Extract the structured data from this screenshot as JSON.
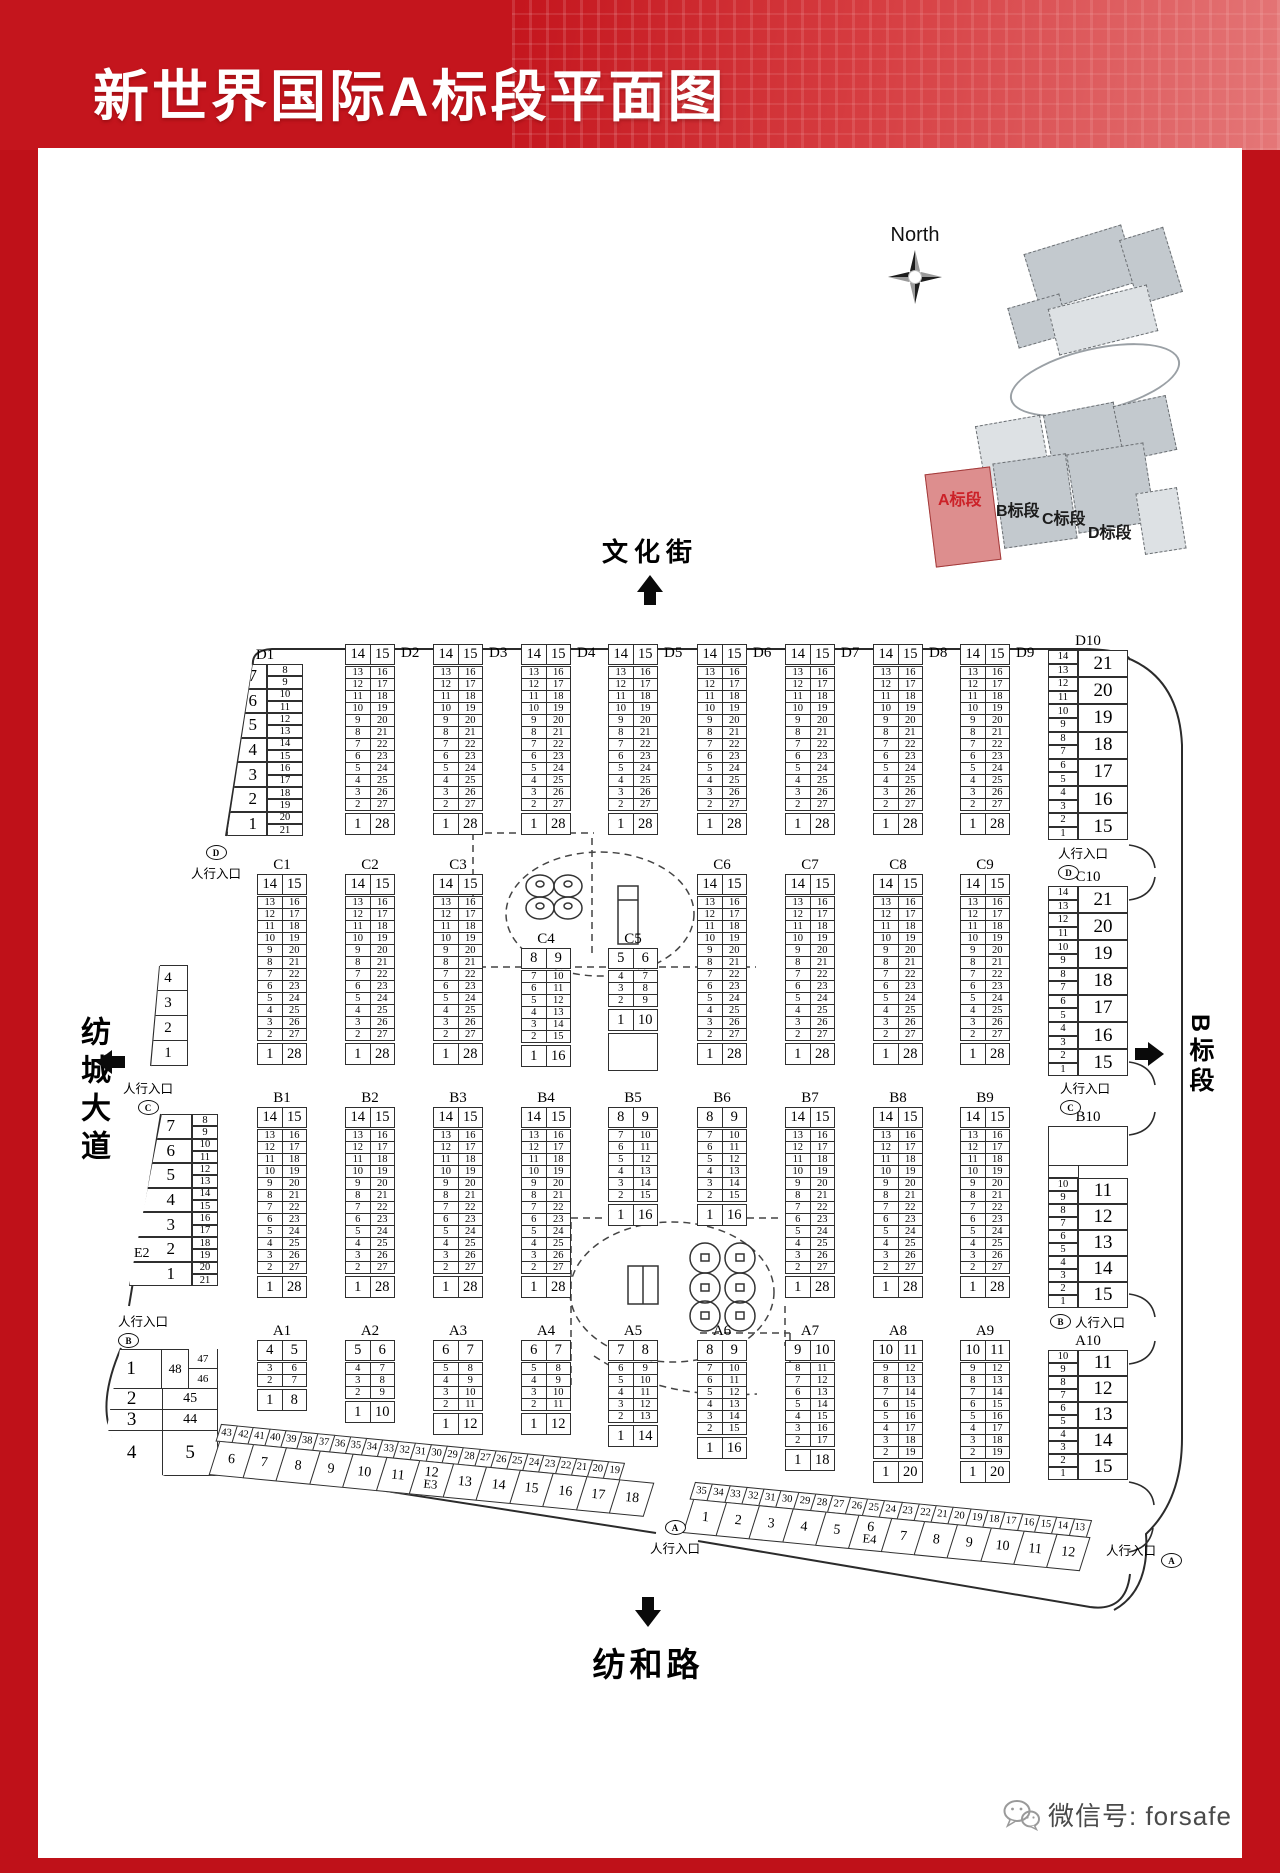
{
  "title": "新世界国际A标段平面图",
  "compass": {
    "label": "North"
  },
  "minimap": {
    "sections": [
      {
        "label": "A标段",
        "highlight": true
      },
      {
        "label": "B标段",
        "highlight": false
      },
      {
        "label": "C标段",
        "highlight": false
      },
      {
        "label": "D标段",
        "highlight": false
      }
    ]
  },
  "streets": {
    "top": "文化街",
    "left": "纺城大道",
    "right": "B标段",
    "bottom": "纺和路"
  },
  "entrance_text": "人行入口",
  "entrances": [
    {
      "letter": "D"
    },
    {
      "letter": "D"
    },
    {
      "letter": "C"
    },
    {
      "letter": "C"
    },
    {
      "letter": "B"
    },
    {
      "letter": "B"
    },
    {
      "letter": "A"
    },
    {
      "letter": "A"
    }
  ],
  "footer": {
    "wechat": "微信号: forsafe"
  },
  "colors": {
    "frame_red": "#bf1119",
    "banner_red": "#c4151d",
    "accent_red": "#cc2128",
    "line": "#2f2f2f"
  },
  "block_types": {
    "std28": {
      "kind": "std",
      "head": [
        "14",
        "15"
      ],
      "mid": [
        [
          "13",
          "16"
        ],
        [
          "12",
          "17"
        ],
        [
          "11",
          "18"
        ],
        [
          "10",
          "19"
        ],
        [
          "9",
          "20"
        ],
        [
          "8",
          "21"
        ],
        [
          "7",
          "22"
        ],
        [
          "6",
          "23"
        ],
        [
          "5",
          "24"
        ],
        [
          "4",
          "25"
        ],
        [
          "3",
          "26"
        ],
        [
          "2",
          "27"
        ]
      ],
      "foot": [
        "1",
        "28"
      ]
    },
    "short16": {
      "kind": "std",
      "head": [
        "8",
        "9"
      ],
      "mid": [
        [
          "7",
          "10"
        ],
        [
          "6",
          "11"
        ],
        [
          "5",
          "12"
        ],
        [
          "4",
          "13"
        ],
        [
          "3",
          "14"
        ],
        [
          "2",
          "15"
        ]
      ],
      "foot": [
        "1",
        "16"
      ]
    },
    "c5t": {
      "kind": "std",
      "head": [
        "5",
        "6"
      ],
      "mid": [
        [
          "4",
          "7"
        ],
        [
          "3",
          "8"
        ],
        [
          "2",
          "9"
        ]
      ],
      "foot": [
        "1",
        "10"
      ],
      "empty": 36
    },
    "a1t": {
      "kind": "std",
      "head": [
        "4",
        "5"
      ],
      "mid": [
        [
          "3",
          "6"
        ],
        [
          "2",
          "7"
        ]
      ],
      "foot": [
        "1",
        "8"
      ]
    },
    "a2t": {
      "kind": "std",
      "head": [
        "5",
        "6"
      ],
      "mid": [
        [
          "4",
          "7"
        ],
        [
          "3",
          "8"
        ],
        [
          "2",
          "9"
        ]
      ],
      "foot": [
        "1",
        "10"
      ]
    },
    "a3t": {
      "kind": "std",
      "head": [
        "6",
        "7"
      ],
      "mid": [
        [
          "5",
          "8"
        ],
        [
          "4",
          "9"
        ],
        [
          "3",
          "10"
        ],
        [
          "2",
          "11"
        ]
      ],
      "foot": [
        "1",
        "12"
      ]
    },
    "a5t": {
      "kind": "std",
      "head": [
        "7",
        "8"
      ],
      "mid": [
        [
          "6",
          "9"
        ],
        [
          "5",
          "10"
        ],
        [
          "4",
          "11"
        ],
        [
          "3",
          "12"
        ],
        [
          "2",
          "13"
        ]
      ],
      "foot": [
        "1",
        "14"
      ]
    },
    "a7t": {
      "kind": "std",
      "head": [
        "9",
        "10"
      ],
      "mid": [
        [
          "8",
          "11"
        ],
        [
          "7",
          "12"
        ],
        [
          "6",
          "13"
        ],
        [
          "5",
          "14"
        ],
        [
          "4",
          "15"
        ],
        [
          "3",
          "16"
        ],
        [
          "2",
          "17"
        ]
      ],
      "foot": [
        "1",
        "18"
      ]
    },
    "a8t": {
      "kind": "std",
      "head": [
        "10",
        "11"
      ],
      "mid": [
        [
          "9",
          "12"
        ],
        [
          "8",
          "13"
        ],
        [
          "7",
          "14"
        ],
        [
          "6",
          "15"
        ],
        [
          "5",
          "16"
        ],
        [
          "4",
          "17"
        ],
        [
          "3",
          "18"
        ],
        [
          "2",
          "19"
        ]
      ],
      "foot": [
        "1",
        "20"
      ]
    },
    "d1t": {
      "kind": "edgeL",
      "big": [
        "7",
        "6",
        "5",
        "4",
        "3",
        "2",
        "1"
      ],
      "small": [
        "8",
        "9",
        "10",
        "11",
        "12",
        "13",
        "14",
        "15",
        "16",
        "17",
        "18",
        "19",
        "20",
        "21"
      ]
    },
    "d10t": {
      "kind": "edgeR",
      "small": [
        "14",
        "13",
        "12",
        "11",
        "10",
        "9",
        "8",
        "7",
        "6",
        "5",
        "4",
        "3",
        "2",
        "1"
      ],
      "big": [
        "21",
        "20",
        "19",
        "18",
        "17",
        "16",
        "15"
      ]
    },
    "b10t": {
      "kind": "edgeR",
      "empty_top": true,
      "small": [
        "10",
        "9",
        "8",
        "7",
        "6",
        "5",
        "4",
        "3",
        "2",
        "1"
      ],
      "big": [
        "11",
        "12",
        "13",
        "14",
        "15"
      ]
    },
    "a10t": {
      "kind": "edgeR",
      "small": [
        "10",
        "9",
        "8",
        "7",
        "6",
        "5",
        "4",
        "3",
        "2",
        "1"
      ],
      "big": [
        "11",
        "12",
        "13",
        "14",
        "15"
      ]
    },
    "cleft": {
      "kind": "bigcol",
      "big": [
        "4",
        "3",
        "2",
        "1"
      ]
    },
    "aleft": {
      "kind": "aleft",
      "rows": [
        [
          "1",
          "48",
          "47",
          "46"
        ],
        [
          "2",
          "45"
        ],
        [
          "3",
          "44"
        ],
        [
          "4",
          "5"
        ]
      ]
    },
    "e3t": {
      "kind": "strip",
      "label": "E3",
      "label_cell": "12",
      "topw": 93,
      "top": [
        "43",
        "42",
        "41",
        "40",
        "39",
        "38",
        "37",
        "36",
        "35",
        "34",
        "33",
        "32",
        "31",
        "30",
        "29",
        "28",
        "27",
        "26",
        "25",
        "24",
        "23",
        "22",
        "21",
        "20",
        "19"
      ],
      "bottom": [
        "6",
        "7",
        "8",
        "9",
        "10",
        "11",
        "12",
        "13",
        "14",
        "15",
        "16",
        "17",
        "18"
      ]
    },
    "e4t": {
      "kind": "strip",
      "label": "E4",
      "label_cell": "6",
      "topw": 100,
      "top": [
        "35",
        "34",
        "33",
        "32",
        "31",
        "30",
        "29",
        "28",
        "27",
        "26",
        "25",
        "24",
        "23",
        "22",
        "21",
        "20",
        "19",
        "18",
        "17",
        "16",
        "15",
        "14",
        "13"
      ],
      "bottom": [
        "1",
        "2",
        "3",
        "4",
        "5",
        "6",
        "7",
        "8",
        "9",
        "10",
        "11",
        "12"
      ]
    }
  },
  "blocks": {
    "D1": {
      "label": "D1",
      "type": "d1t",
      "label_pos": "top"
    },
    "D2": {
      "label": "D2",
      "type": "std28",
      "label_pos": "right"
    },
    "D3": {
      "label": "D3",
      "type": "std28",
      "label_pos": "right"
    },
    "D4": {
      "label": "D4",
      "type": "std28",
      "label_pos": "right"
    },
    "D5": {
      "label": "D5",
      "type": "std28",
      "label_pos": "right"
    },
    "D6": {
      "label": "D6",
      "type": "std28",
      "label_pos": "right"
    },
    "D7": {
      "label": "D7",
      "type": "std28",
      "label_pos": "right"
    },
    "D8": {
      "label": "D8",
      "type": "std28",
      "label_pos": "right"
    },
    "D9": {
      "label": "D9",
      "type": "std28",
      "label_pos": "right"
    },
    "D10": {
      "label": "D10",
      "type": "d10t",
      "label_pos": "top"
    },
    "C0": {
      "type": "cleft"
    },
    "C1": {
      "label": "C1",
      "type": "std28",
      "label_pos": "top"
    },
    "C2": {
      "label": "C2",
      "type": "std28",
      "label_pos": "top"
    },
    "C3": {
      "label": "C3",
      "type": "std28",
      "label_pos": "top"
    },
    "C4": {
      "label": "C4",
      "type": "short16",
      "label_pos": "top"
    },
    "C5": {
      "label": "C5",
      "type": "c5t",
      "label_pos": "top"
    },
    "C6": {
      "label": "C6",
      "type": "std28",
      "label_pos": "top"
    },
    "C7": {
      "label": "C7",
      "type": "std28",
      "label_pos": "top"
    },
    "C8": {
      "label": "C8",
      "type": "std28",
      "label_pos": "top"
    },
    "C9": {
      "label": "C9",
      "type": "std28",
      "label_pos": "top"
    },
    "C10": {
      "label": "C10",
      "type": "d10t",
      "label_pos": "top"
    },
    "E2": {
      "type": "d1t",
      "tag": "E2"
    },
    "B1": {
      "label": "B1",
      "type": "std28",
      "label_pos": "top"
    },
    "B2": {
      "label": "B2",
      "type": "std28",
      "label_pos": "top"
    },
    "B3": {
      "label": "B3",
      "type": "std28",
      "label_pos": "top"
    },
    "B4": {
      "label": "B4",
      "type": "std28",
      "label_pos": "top"
    },
    "B5": {
      "label": "B5",
      "type": "short16",
      "label_pos": "top"
    },
    "B6": {
      "label": "B6",
      "type": "short16",
      "label_pos": "top"
    },
    "B7": {
      "label": "B7",
      "type": "std28",
      "label_pos": "top"
    },
    "B8": {
      "label": "B8",
      "type": "std28",
      "label_pos": "top"
    },
    "B9": {
      "label": "B9",
      "type": "std28",
      "label_pos": "top"
    },
    "B10": {
      "label": "B10",
      "type": "b10t",
      "label_pos": "top"
    },
    "AL": {
      "type": "aleft"
    },
    "A1": {
      "label": "A1",
      "type": "a1t",
      "label_pos": "top"
    },
    "A2": {
      "label": "A2",
      "type": "a2t",
      "label_pos": "top"
    },
    "A3": {
      "label": "A3",
      "type": "a3t",
      "label_pos": "top"
    },
    "A4": {
      "label": "A4",
      "type": "a3t",
      "label_pos": "top"
    },
    "A5": {
      "label": "A5",
      "type": "a5t",
      "label_pos": "top"
    },
    "A6": {
      "label": "A6",
      "type": "short16",
      "label_pos": "top"
    },
    "A7": {
      "label": "A7",
      "type": "a7t",
      "label_pos": "top"
    },
    "A8": {
      "label": "A8",
      "type": "a8t",
      "label_pos": "top"
    },
    "A9": {
      "label": "A9",
      "type": "a8t",
      "label_pos": "top"
    },
    "A10": {
      "label": "A10",
      "type": "a10t",
      "label_pos": "top"
    },
    "E3": {
      "type": "e3t"
    },
    "E4": {
      "type": "e4t"
    }
  }
}
